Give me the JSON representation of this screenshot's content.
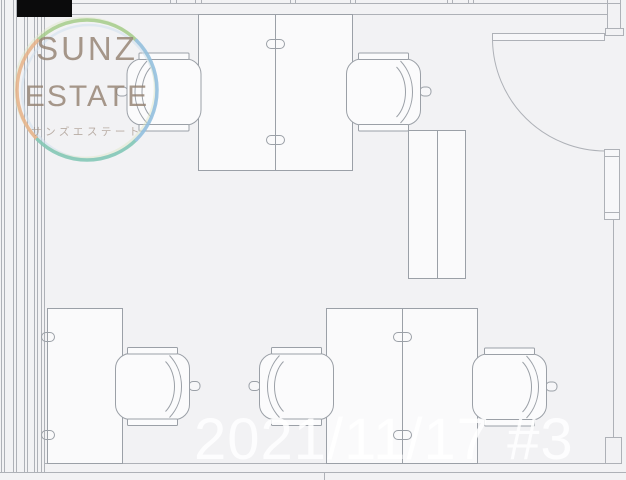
{
  "brand": {
    "name_line1": "SUNZ",
    "name_line2": "ESTATE",
    "subtitle_katakana": "サンズエステート",
    "text_color": "#96816f",
    "ring_colors": {
      "top": "#a6cd8b",
      "left": "#e7b287",
      "bottom": "#7fc6b4",
      "right": "#90bede"
    }
  },
  "watermark": {
    "date_stamp": "2021/11/17 #3",
    "color": "#ffffff"
  },
  "floorplan": {
    "background": "#f2f2f4",
    "wall_line_color": "#aeb1b7",
    "furniture_line_color": "#9ba0a7",
    "elements": {
      "desks": 3,
      "office_chairs": 5,
      "cabinets": 1,
      "doors": 1
    }
  }
}
